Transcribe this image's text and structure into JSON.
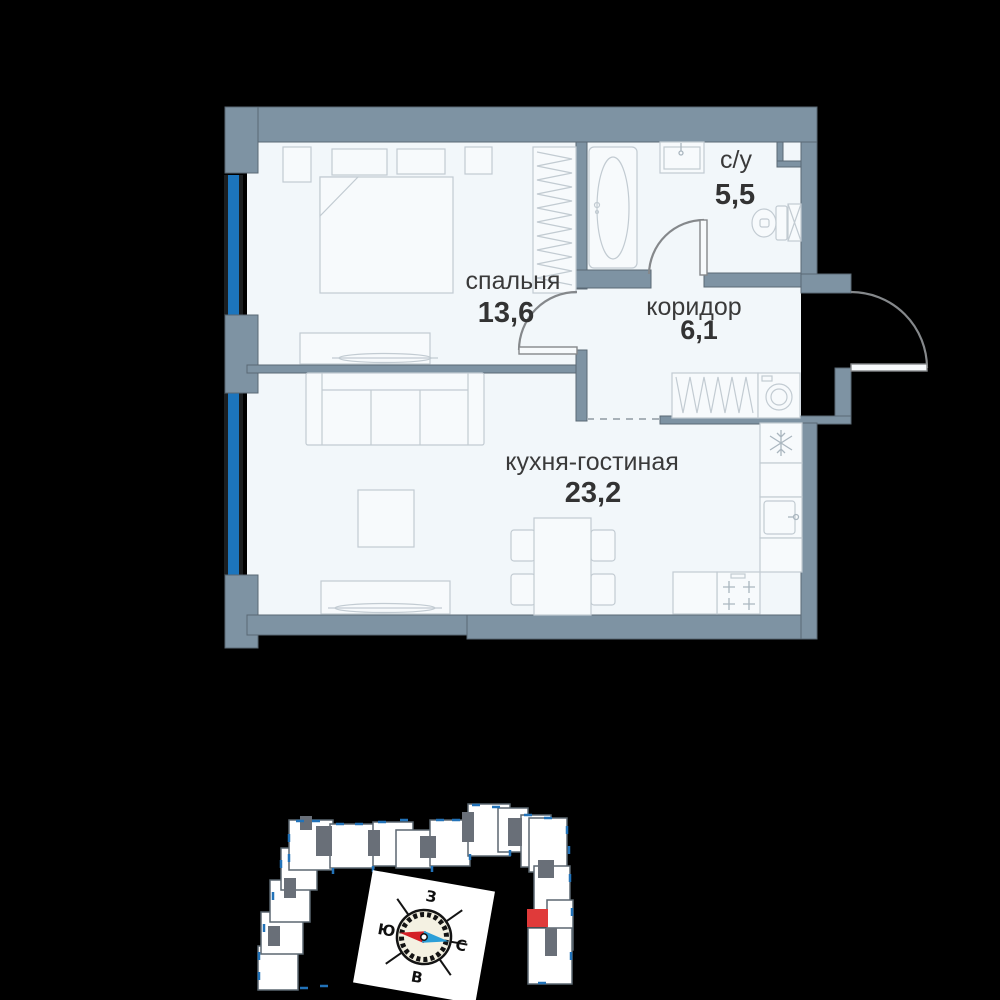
{
  "floor_plan": {
    "rooms": [
      {
        "name": "спальня",
        "area": "13,6"
      },
      {
        "name": "с/у",
        "area": "5,5"
      },
      {
        "name": "коридор",
        "area": "6,1"
      },
      {
        "name": "кухня-гостиная",
        "area": "23,2"
      }
    ]
  },
  "site_plan": {
    "compass": {
      "west": "З",
      "south": "Ю",
      "north": "С",
      "east": "В"
    }
  },
  "colors": {
    "background": "#000000",
    "wall": "#7e93a3",
    "wall_outline": "#5a6874",
    "floor": "#f2f7fa",
    "window_glass": "#1c75bd",
    "furniture_line": "#c2cbd2",
    "door_arc": "#85888b",
    "label_text": "#3a3a3a",
    "building_block": "#ffffff",
    "building_core": "#696f78",
    "building_window_tick": "#2272b8",
    "apartment_highlight": "#e03a3a",
    "compass_face": "#f4f1e2",
    "compass_needle_south": "#d42027",
    "compass_needle_north": "#2b9fd8"
  }
}
